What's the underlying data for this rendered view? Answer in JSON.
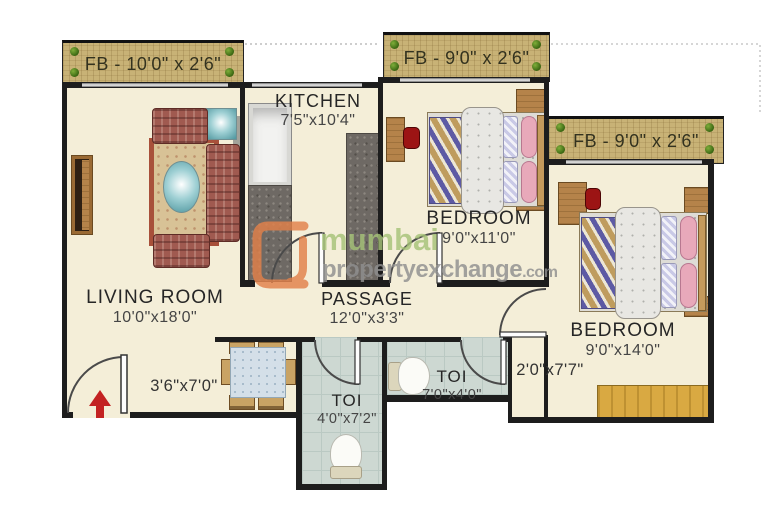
{
  "banners": {
    "fb1": "FB - 10'0\" x 2'6\"",
    "fb2": "FB - 9'0\" x 2'6\"",
    "fb3": "FB - 9'0\" x 2'6\""
  },
  "rooms": {
    "living": {
      "name": "LIVING ROOM",
      "dims": "10'0\"x18'0\""
    },
    "kitchen": {
      "name": "KITCHEN",
      "dims": "7'5\"x10'4\""
    },
    "bedroom1": {
      "name": "BEDROOM",
      "dims": "9'0\"x11'0\""
    },
    "bedroom2": {
      "name": "BEDROOM",
      "dims": "9'0\"x14'0\""
    },
    "passage": {
      "name": "PASSAGE",
      "dims": "12'0\"x3'3\""
    },
    "toi1": {
      "name": "TOI",
      "dims": "4'0\"x7'2\""
    },
    "toi2": {
      "name": "TOI",
      "dims": "7'0\"x4'0\""
    }
  },
  "annotations": {
    "nook": "3'6\"x7'0\"",
    "corridor": "2'0\"x7'7\""
  },
  "watermark": {
    "line1": "mumbai",
    "line2": "propertyexchange",
    "tld": ".com"
  },
  "colors": {
    "wall": "#1d1d1d",
    "floor_cream": "#f4eed8",
    "toilet_tile": "#cdd8d2",
    "flower_bed_wood": "#c8b276",
    "granite_counter": "#6e6964",
    "furniture_wood": "#b5834a",
    "wardrobe_yellow": "#d9a942",
    "sofa_maroon": "#a05a50",
    "entry_arrow_red": "#c32222",
    "watermark_green": "#a6c378",
    "watermark_gray": "#8f8f8f",
    "watermark_orange": "#e2814a"
  },
  "furniture_icons": [
    "sofa-set-icon",
    "coffee-table-icon",
    "tv-unit-icon",
    "dining-table-icon",
    "double-bed-icon",
    "nightstand-icon",
    "study-desk-icon",
    "chair-icon",
    "wardrobe-icon",
    "kitchen-counter-icon",
    "sink-unit-icon",
    "toilet-icon",
    "entry-arrow-icon",
    "door-swing-icon",
    "shrub-icon"
  ]
}
